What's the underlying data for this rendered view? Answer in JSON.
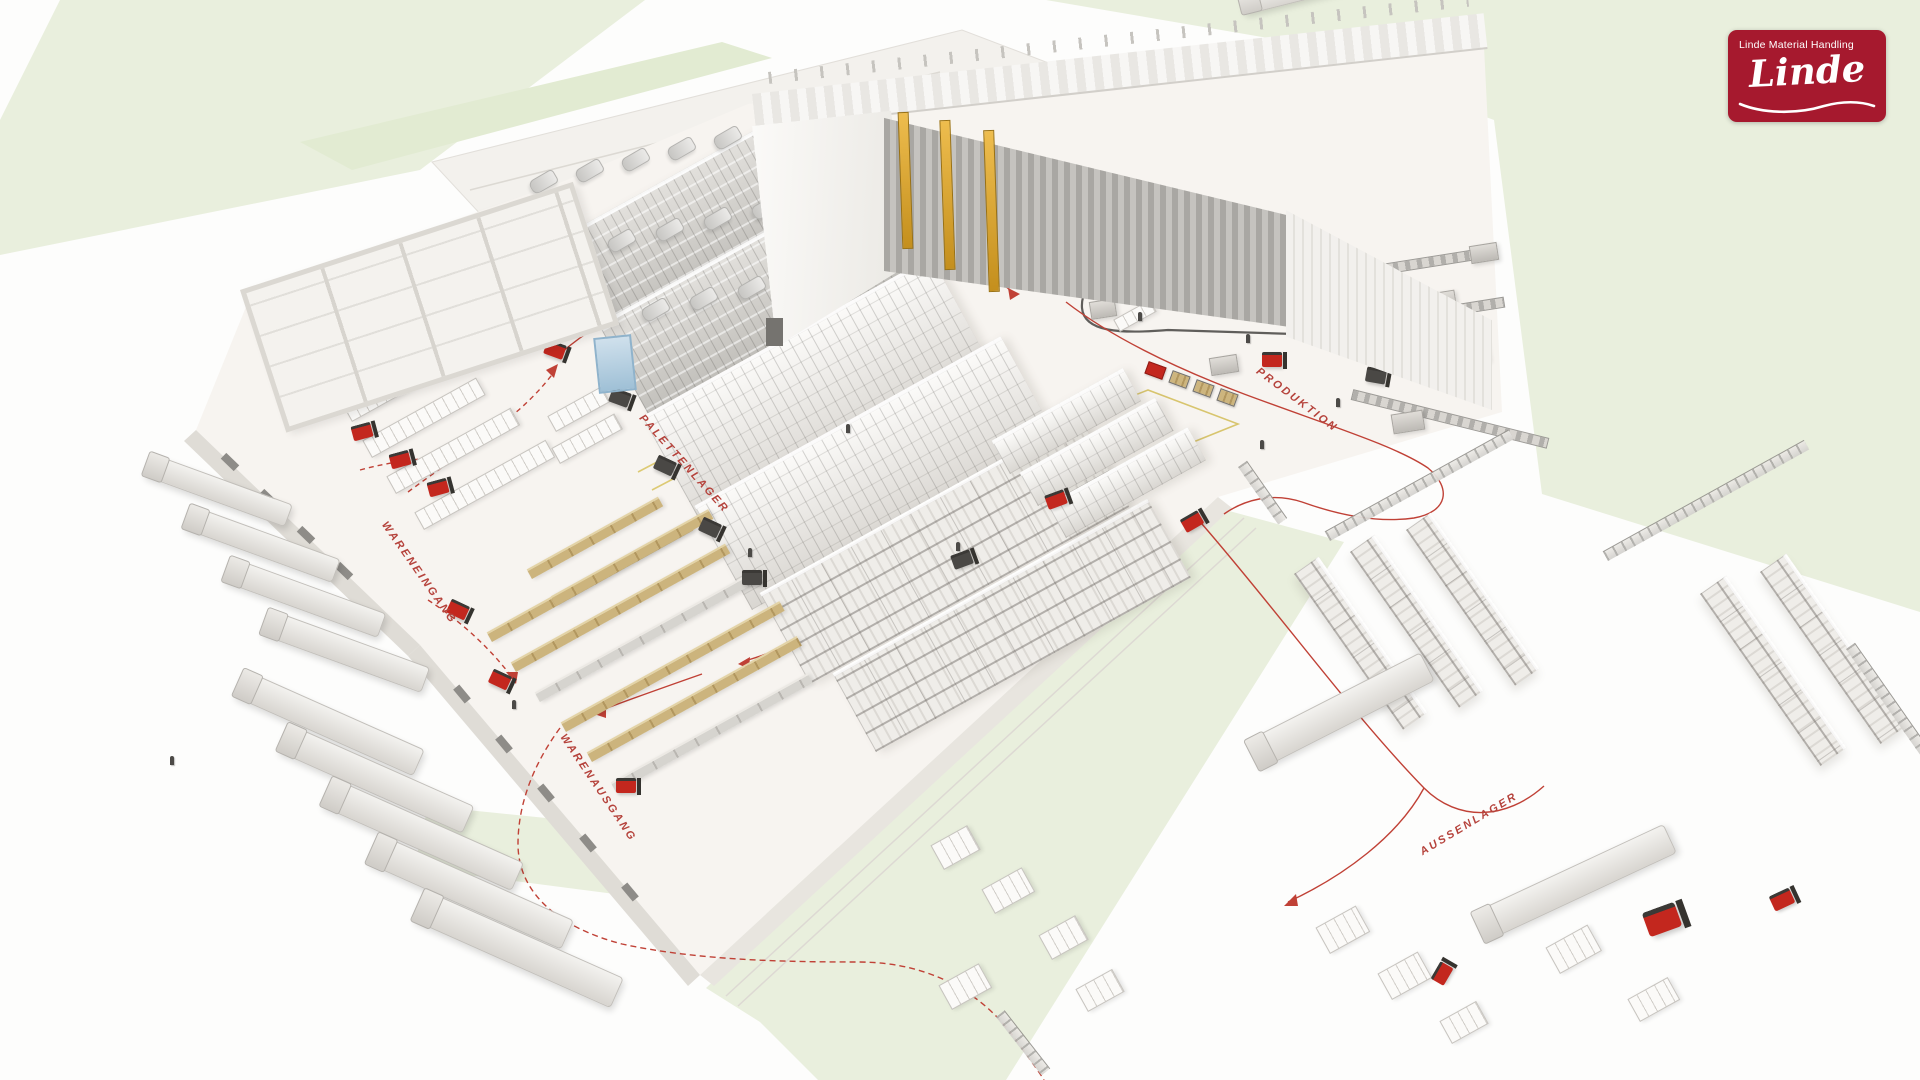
{
  "brand": {
    "tagline": "Linde Material Handling",
    "wordmark": "Linde"
  },
  "zone_labels": {
    "palettenlager": "PALETTENLAGER",
    "wareneingang": "WARENEINGANG",
    "produktion": "PRODUKTION",
    "warenausgang": "WARENAUSGANG",
    "aussenlager": "AUSSENLAGER"
  },
  "colors": {
    "linde_red": "#A6192E",
    "label_red": "#B5423B",
    "route_red": "#C04136",
    "crane_yellow": "#DFA83C",
    "grass_green": "#E9EFDD",
    "floor_light": "#F7F4F0",
    "long_goods_tan": "#CBB27E"
  }
}
